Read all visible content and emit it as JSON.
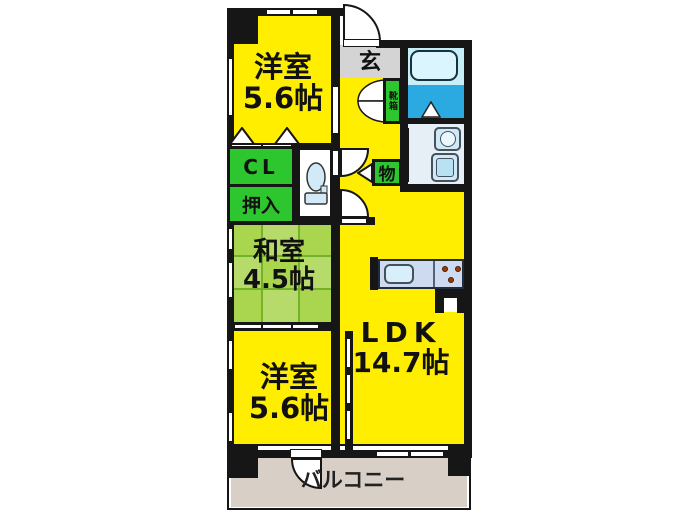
{
  "floorplan": {
    "rooms": {
      "bedroom_top": {
        "name": "洋室",
        "size": "5.6帖"
      },
      "tatami_room": {
        "name": "和室",
        "size": "4.5帖"
      },
      "bedroom_bottom": {
        "name": "洋室",
        "size": "5.6帖"
      },
      "ldk": {
        "name": "LDK",
        "size": "14.7帖"
      }
    },
    "labels": {
      "entrance": "玄",
      "shoe_cabinet": "靴箱",
      "closet": "CL",
      "oshiire": "押入",
      "storage": "物",
      "balcony": "バルコニー"
    },
    "colors": {
      "room_yellow": "#ffee00",
      "closet_green": "#2ec62e",
      "tatami_green": "#a9d54f",
      "tatami_line": "#74b228",
      "bath_blue": "#2baae2",
      "bathtub_area": "#c6effa",
      "entrance_gray": "#d4d4d4",
      "balcony_beige": "#d8cfc7",
      "wall_black": "#161616",
      "fixture_blue": "#cfe9f6",
      "kitchen_counter": "#cedaf0"
    }
  }
}
